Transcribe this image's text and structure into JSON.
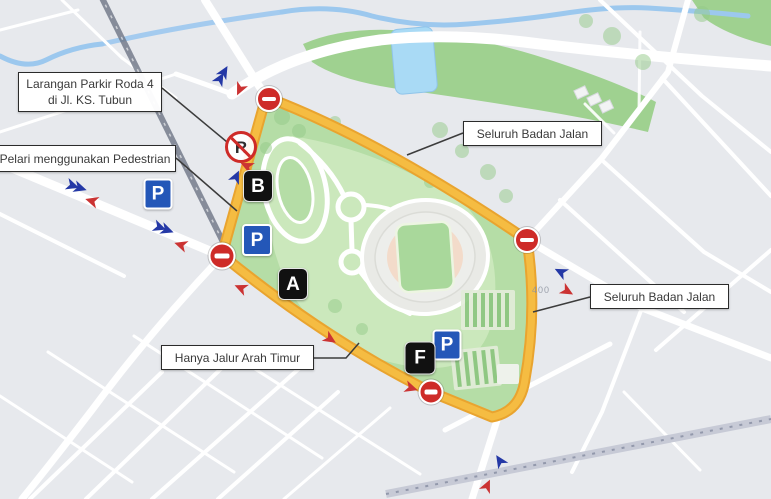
{
  "map": {
    "theme": {
      "bg_gray": "#E7E9ED",
      "road_white": "#FFFFFF",
      "park_bright": "#9FD190",
      "interior_green": "#B5DDA6",
      "inner_green": "#CBE8BC",
      "water_blue": "#9CC8EE",
      "pool_blue": "#A9DAF5",
      "route_yellow": "#F5BC42",
      "route_edge": "#E9A42F",
      "rail_dark": "#6E7686",
      "rail_light": "#C7CAD6",
      "sign_red": "#CE2B28",
      "parking_blue": "#2457B8",
      "marker_black": "#111111",
      "arrow_blue": "#2438A6",
      "arrow_red": "#CB3333",
      "callout_border": "#2B2B2B",
      "callout_text": "#3A3A3A",
      "stadium_gray": "#E9EAE6",
      "track_peach": "#F3DBCA",
      "field_green": "#A9D89B"
    },
    "annotations": {
      "labels": [
        {
          "name": "label-larangan-parkir",
          "lines": [
            "Larangan Parkir Roda 4",
            "di Jl. KS. Tubun"
          ],
          "box": {
            "x": 18,
            "y": 72,
            "w": 144,
            "h": 40
          },
          "connector": [
            [
              162,
              88
            ],
            [
              227,
              142
            ]
          ]
        },
        {
          "name": "label-pelari-pedestrian",
          "lines": [
            "Pelari menggunakan Pedestrian"
          ],
          "box": {
            "x": -6,
            "y": 145,
            "w": 182,
            "h": 27
          },
          "connector": [
            [
              176,
              158
            ],
            [
              237,
              211
            ]
          ]
        },
        {
          "name": "label-seluruh-badan-jalan-atas",
          "lines": [
            "Seluruh Badan Jalan"
          ],
          "box": {
            "x": 463,
            "y": 121,
            "w": 139,
            "h": 25
          },
          "connector": [
            [
              463,
              133
            ],
            [
              407,
              155
            ]
          ]
        },
        {
          "name": "label-seluruh-badan-jalan-kanan",
          "lines": [
            "Seluruh Badan Jalan"
          ],
          "box": {
            "x": 590,
            "y": 284,
            "w": 139,
            "h": 25
          },
          "connector": [
            [
              590,
              297
            ],
            [
              533,
              312
            ]
          ]
        },
        {
          "name": "label-hanya-jalur-arah-timur",
          "lines": [
            "Hanya Jalur Arah Timur"
          ],
          "box": {
            "x": 161,
            "y": 345,
            "w": 153,
            "h": 25
          },
          "connector": [
            [
              314,
              358
            ],
            [
              346,
              358
            ],
            [
              359,
              343
            ]
          ]
        }
      ],
      "no_entry_signs": [
        {
          "x": 269,
          "y": 99,
          "d": 26
        },
        {
          "x": 222,
          "y": 256,
          "d": 27
        },
        {
          "x": 527,
          "y": 240,
          "d": 26
        },
        {
          "x": 431,
          "y": 392,
          "d": 25
        }
      ],
      "no_parking_sign": {
        "x": 241,
        "y": 147,
        "d": 32,
        "glyph": "R"
      },
      "parking_signs": [
        {
          "x": 158,
          "y": 194,
          "s": 29
        },
        {
          "x": 257,
          "y": 240,
          "s": 30
        },
        {
          "x": 447,
          "y": 345,
          "s": 29
        }
      ],
      "route_markers": [
        {
          "label": "B",
          "x": 258,
          "y": 186,
          "s": 30
        },
        {
          "label": "A",
          "x": 293,
          "y": 284,
          "s": 30
        },
        {
          "label": "F",
          "x": 420,
          "y": 358,
          "s": 31
        }
      ],
      "arrows": [
        {
          "x": 224,
          "y": 72,
          "a": -60,
          "c": "blue",
          "double": true
        },
        {
          "x": 240,
          "y": 89,
          "a": 115,
          "c": "red",
          "double": false
        },
        {
          "x": 80,
          "y": 188,
          "a": 18,
          "c": "blue",
          "double": true
        },
        {
          "x": 92,
          "y": 201,
          "a": 197,
          "c": "red",
          "double": false
        },
        {
          "x": 167,
          "y": 230,
          "a": 20,
          "c": "blue",
          "double": true
        },
        {
          "x": 181,
          "y": 245,
          "a": 198,
          "c": "red",
          "double": false
        },
        {
          "x": 236,
          "y": 177,
          "a": -65,
          "c": "blue",
          "double": false
        },
        {
          "x": 247,
          "y": 166,
          "a": 205,
          "c": "red",
          "double": false
        },
        {
          "x": 241,
          "y": 288,
          "a": 203,
          "c": "red",
          "double": false
        },
        {
          "x": 330,
          "y": 339,
          "a": 33,
          "c": "red",
          "double": false
        },
        {
          "x": 411,
          "y": 388,
          "a": 18,
          "c": "red",
          "double": false
        },
        {
          "x": 561,
          "y": 272,
          "a": 207,
          "c": "blue",
          "double": false
        },
        {
          "x": 567,
          "y": 291,
          "a": 30,
          "c": "red",
          "double": false
        },
        {
          "x": 500,
          "y": 461,
          "a": 237,
          "c": "blue",
          "double": false
        },
        {
          "x": 487,
          "y": 486,
          "a": -65,
          "c": "red",
          "double": false
        }
      ],
      "map_texts": [
        {
          "text": "400",
          "x": 541,
          "y": 290
        }
      ]
    }
  }
}
